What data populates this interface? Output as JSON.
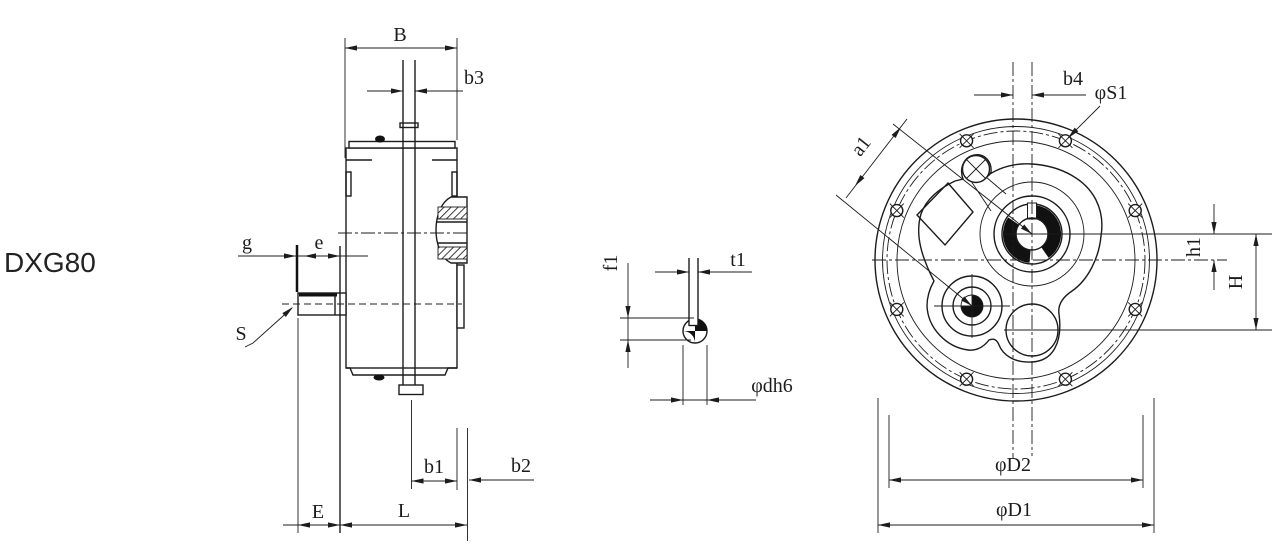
{
  "page": {
    "background": "#ffffff",
    "line_color": "#1c1c1c"
  },
  "title": {
    "model": "DXG80"
  },
  "views": {
    "side_view": {
      "dims": [
        "B",
        "b3",
        "g",
        "e",
        "S",
        "E",
        "L",
        "b1",
        "b2"
      ]
    },
    "shaft_key_detail": {
      "dims": [
        "f1",
        "t1",
        "φdh6"
      ]
    },
    "front_view": {
      "dims": [
        "b4",
        "φS1",
        "a1",
        "h1",
        "H",
        "φD2",
        "φD1"
      ]
    }
  },
  "labels": {
    "model": "DXG80",
    "B": "B",
    "b3": "b3",
    "g": "g",
    "e": "e",
    "S": "S",
    "E": "E",
    "L": "L",
    "b1": "b1",
    "b2": "b2",
    "f1": "f1",
    "t1": "t1",
    "d_h6": "φdh6",
    "b4": "b4",
    "S1": "φS1",
    "a1": "a1",
    "h1": "h1",
    "H": "H",
    "D2": "φD2",
    "D1": "φD1"
  }
}
